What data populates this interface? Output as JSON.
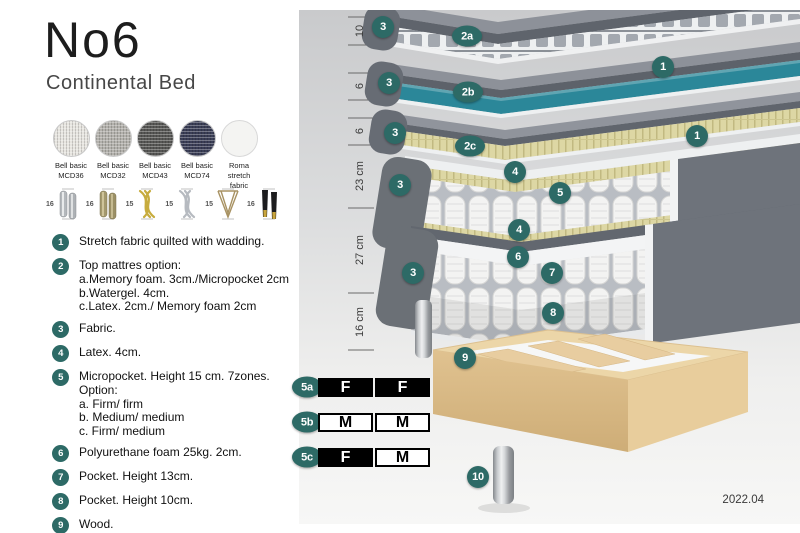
{
  "title": "No6",
  "subtitle": "Continental Bed",
  "fabrics": [
    {
      "line1": "Bell basic",
      "line2": "MCD36",
      "color": "#e7e5e0"
    },
    {
      "line1": "Bell basic",
      "line2": "MCD32",
      "color": "#b3b1ac"
    },
    {
      "line1": "Bell basic",
      "line2": "MCD43",
      "color": "#575755"
    },
    {
      "line1": "Bell basic",
      "line2": "MCD74",
      "color": "#3a3e56"
    },
    {
      "line1": "Roma",
      "line2": "stretch fabric",
      "color": "#f4f4f2"
    }
  ],
  "legs": [
    {
      "height": "16",
      "type": "cylinder-chrome"
    },
    {
      "height": "16",
      "type": "cylinder-brass"
    },
    {
      "height": "15",
      "type": "twisted-gold"
    },
    {
      "height": "15",
      "type": "twisted-silver"
    },
    {
      "height": "15",
      "type": "hairpin"
    },
    {
      "height": "16",
      "type": "tapered-black-gold"
    }
  ],
  "list_items": [
    {
      "num": "1",
      "text": "Stretch fabric quilted with wadding."
    },
    {
      "num": "2",
      "text": "Top mattres option:",
      "sub": [
        "a.Memory foam. 3cm./Micropocket 2cm",
        "b.Watergel. 4cm.",
        "c.Latex. 2cm./ Memory foam 2cm"
      ]
    },
    {
      "num": "3",
      "text": "Fabric."
    },
    {
      "num": "4",
      "text": "Latex. 4cm."
    },
    {
      "num": "5",
      "text": "Micropocket. Height 15 cm. 7zones. Option:",
      "sub": [
        "a. Firm/ firm",
        "b. Medium/ medium",
        "c. Firm/ medium"
      ]
    },
    {
      "num": "6",
      "text": "Polyurethane foam 25kg. 2cm."
    },
    {
      "num": "7",
      "text": "Pocket. Height 13cm."
    },
    {
      "num": "8",
      "text": "Pocket. Height 10cm."
    },
    {
      "num": "9",
      "text": "Wood."
    },
    {
      "num": "10",
      "text": "Metal leg. Height 16cm."
    }
  ],
  "diagram": {
    "measurements": [
      "10",
      "6",
      "6",
      "23 cm",
      "27 cm",
      "16 cm"
    ],
    "callouts": [
      "3",
      "2a",
      "1",
      "3",
      "2b",
      "3",
      "2c",
      "1",
      "4",
      "5",
      "3",
      "4",
      "6",
      "7",
      "3",
      "8",
      "9",
      "10"
    ],
    "firmness_rows": [
      {
        "label": "5a",
        "cells": [
          {
            "text": "F",
            "style": "dark"
          },
          {
            "text": "F",
            "style": "dark"
          }
        ]
      },
      {
        "label": "5b",
        "cells": [
          {
            "text": "M",
            "style": "light"
          },
          {
            "text": "M",
            "style": "light"
          }
        ]
      },
      {
        "label": "5c",
        "cells": [
          {
            "text": "F",
            "style": "dark"
          },
          {
            "text": "M",
            "style": "light"
          }
        ]
      }
    ],
    "version": "2022.04"
  },
  "colors": {
    "badge_teal": "#2d6a66",
    "watergel_teal": "#2b8799",
    "latex_yellow": "#ddd7a4",
    "mattress_gray": "#6b7076",
    "wood": "#e0c290",
    "chrome_leg": "#c6c9cc",
    "firmness_black": "#000000"
  }
}
